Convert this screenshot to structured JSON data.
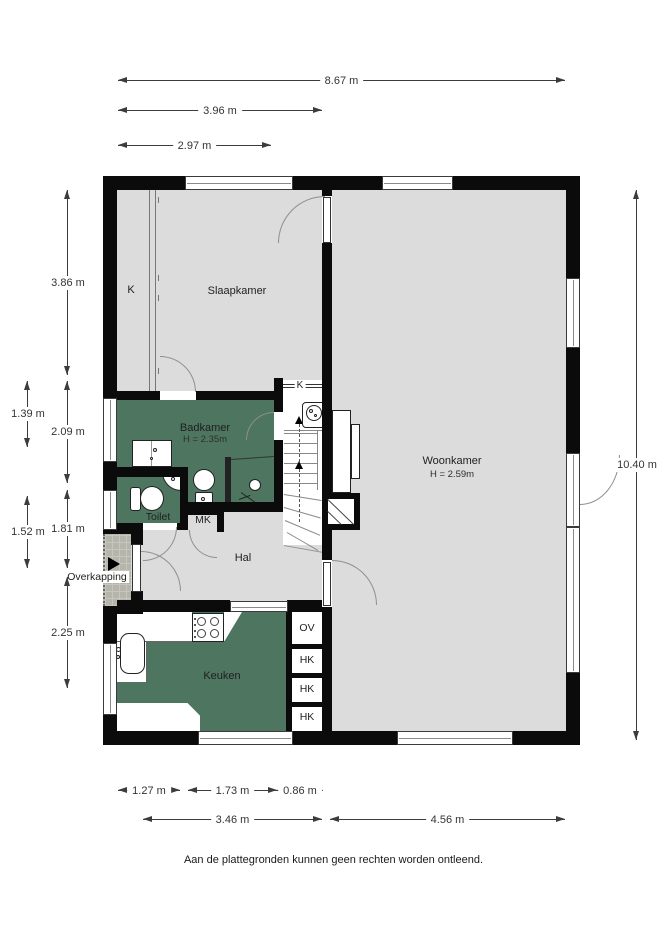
{
  "disclaimer": "Aan de plattegronden kunnen geen rechten worden ontleend.",
  "rooms": {
    "slaapkamer": "Slaapkamer",
    "woonkamer": "Woonkamer",
    "woonkamer_height": "H = 2.59m",
    "badkamer": "Badkamer",
    "badkamer_height": "H = 2.35m",
    "toilet": "Toilet",
    "hal": "Hal",
    "keuken": "Keuken",
    "overkapping": "Overkapping",
    "mk": "MK",
    "k_wardrobe": "K",
    "k_stair": "K",
    "closets": [
      "OV",
      "HK",
      "HK",
      "HK"
    ]
  },
  "dimensions": {
    "top": [
      "8.67 m",
      "3.96 m",
      "2.97 m"
    ],
    "left": [
      "3.86 m",
      "1.39 m",
      "2.09 m",
      "1.81 m",
      "1.52 m",
      "2.25 m"
    ],
    "right": [
      "10.40 m"
    ],
    "bottom_row1": [
      "1.27 m",
      "1.73 m",
      "0.86 m"
    ],
    "bottom_row2": [
      "3.46 m",
      "4.56 m"
    ]
  },
  "colors": {
    "wall": "#0b0b0b",
    "floor": "#dcdcdc",
    "wet_room_floor": "#4e7560",
    "porch": "#b5b5ac"
  }
}
